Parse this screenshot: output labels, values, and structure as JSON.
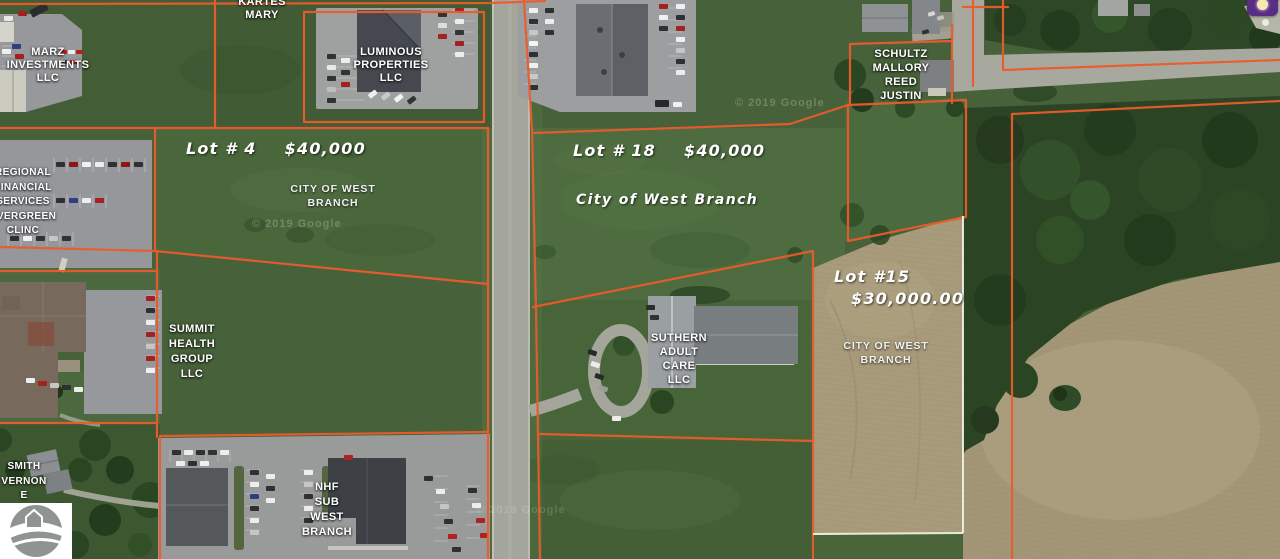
{
  "attribution": {
    "text": "© 2019 Google"
  },
  "lots": {
    "lot4": {
      "name": "Lot # 4",
      "price": "$40,000"
    },
    "lot18": {
      "name": "Lot # 18",
      "price": "$40,000"
    },
    "lot15": {
      "name": "Lot #15",
      "price": "$30,000.00"
    }
  },
  "city_labels": {
    "lot4": [
      "CITY OF WEST",
      "BRANCH"
    ],
    "lot18": "City of West Branch",
    "lot15": [
      "CITY OF WEST",
      "BRANCH"
    ]
  },
  "owners": {
    "marz": [
      "MARZ",
      "INVESTMENTS",
      "LLC"
    ],
    "kartes": [
      "KARTES",
      "MARY"
    ],
    "luminous": [
      "LUMINOUS",
      "PROPERTIES",
      "LLC"
    ],
    "schultz": [
      "SCHULTZ",
      "MALLORY",
      "REED",
      "JUSTIN"
    ],
    "regional": [
      "REGIONAL",
      "FINANCIAL",
      "SERVICES",
      "EVERGREEN",
      "CLINC"
    ],
    "summit": [
      "SUMMIT",
      "HEALTH",
      "GROUP",
      "LLC"
    ],
    "suthern": [
      "SUTHERN",
      "ADULT",
      "CARE",
      "LLC"
    ],
    "smith": [
      "SMITH",
      "VERNON",
      "E"
    ],
    "nhf": [
      "NHF",
      "SUB",
      "WEST",
      "BRANCH"
    ]
  },
  "colors": {
    "parcel_line": "#ec5b2c",
    "survey_line": "#f4f4ea",
    "grass": "#47613a",
    "plowed_field": "#a89b7c",
    "road": "#a4a69c",
    "overlay_icon_bg": "#5a2d85"
  },
  "icons": {
    "lightbulb": "lightbulb",
    "mls_logo": "gray-circle-house-road"
  }
}
